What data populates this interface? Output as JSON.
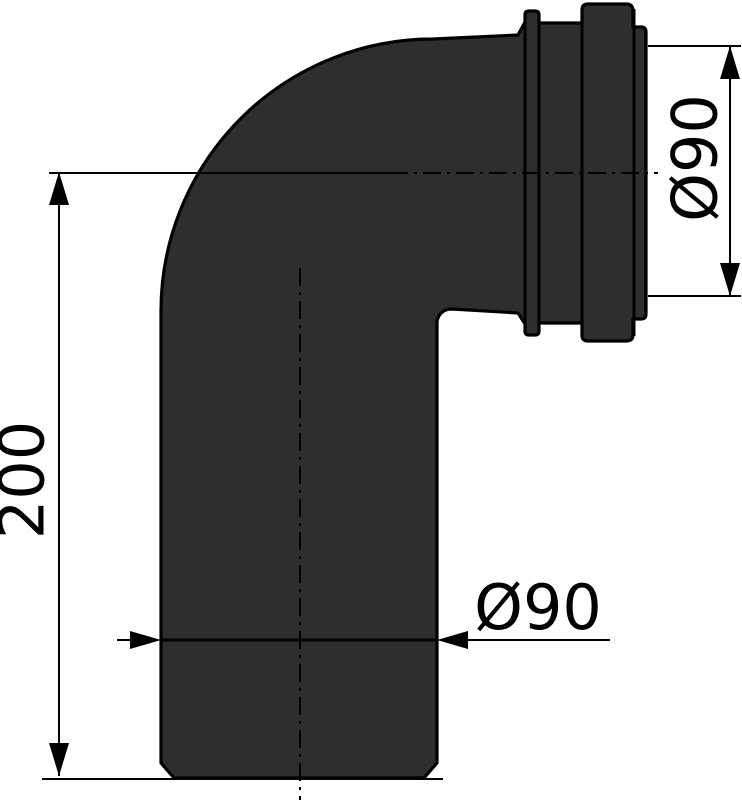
{
  "labels": {
    "height": "200",
    "socket_diameter": "Ø90",
    "pipe_diameter": "Ø90"
  },
  "colors": {
    "background": "#ffffff",
    "silhouette_fill": "#2e2e2e",
    "line_color": "#000000"
  }
}
